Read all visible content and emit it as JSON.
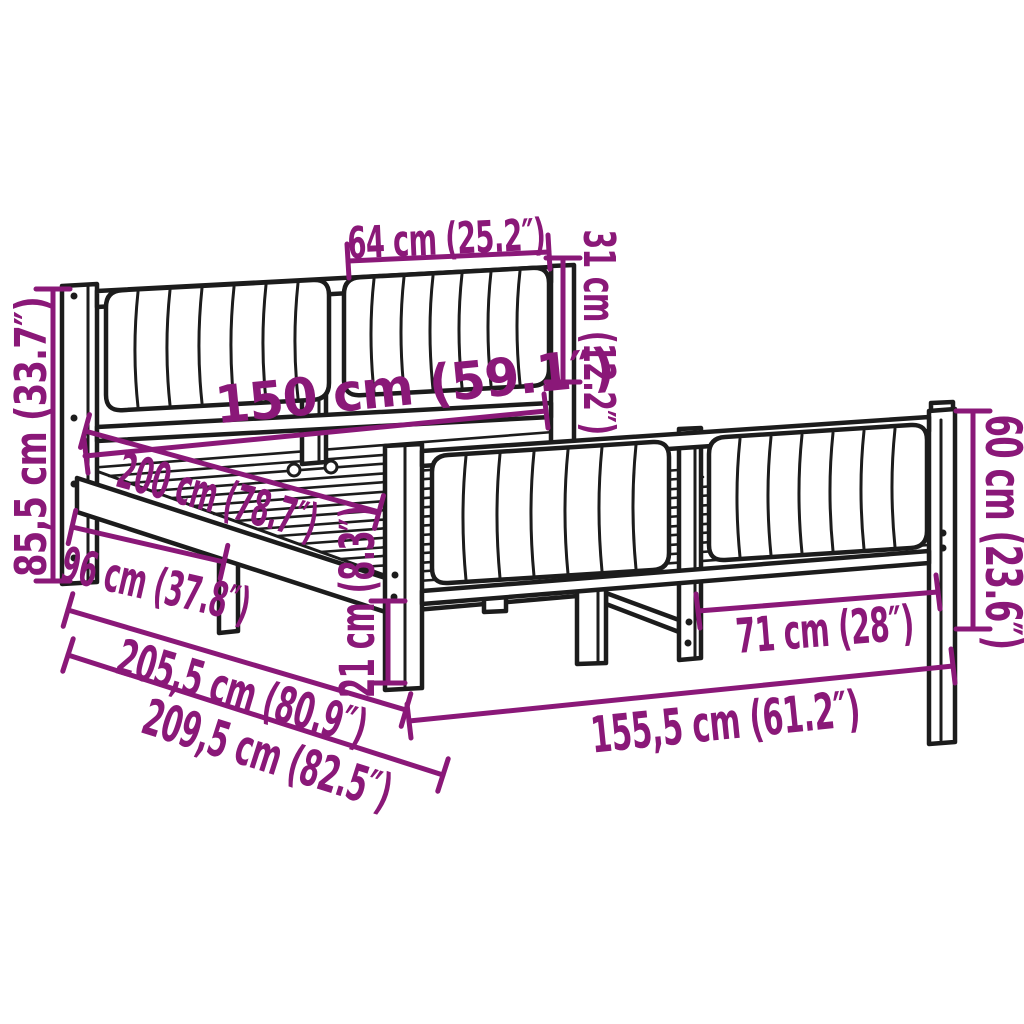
{
  "page": {
    "background_color": "#ffffff",
    "drawing_line_color": "#1c1c1c",
    "dimension_color": "#8a1878",
    "subject": "bed frame with upholstered headboard and footboard, perspective line drawing with dimension annotations"
  },
  "measurements": [
    {
      "id": "headboard-cushion-width",
      "label": "64 cm (25.2″)",
      "cm": "64",
      "inches": "25.2"
    },
    {
      "id": "headboard-cushion-height",
      "label": "31 cm (12.2″)",
      "cm": "31",
      "inches": "12.2"
    },
    {
      "id": "headboard-height",
      "label": "85,5 cm (33.7″)",
      "cm": "85,5",
      "inches": "33.7"
    },
    {
      "id": "mattress-width",
      "label": "150 cm (59.1″)",
      "cm": "150",
      "inches": "59.1"
    },
    {
      "id": "mattress-length",
      "label": "200 cm (78.7″)",
      "cm": "200",
      "inches": "78.7"
    },
    {
      "id": "side-support-distance",
      "label": "96 cm (37.8″)",
      "cm": "96",
      "inches": "37.8"
    },
    {
      "id": "under-bed-clearance",
      "label": "21 cm (8.3″)",
      "cm": "21",
      "inches": "8.3"
    },
    {
      "id": "frame-length",
      "label": "205,5 cm (80.9″)",
      "cm": "205,5",
      "inches": "80.9"
    },
    {
      "id": "total-length",
      "label": "209,5 cm (82.5″)",
      "cm": "209,5",
      "inches": "82.5"
    },
    {
      "id": "total-width",
      "label": "155,5 cm (61.2″)",
      "cm": "155,5",
      "inches": "61.2"
    },
    {
      "id": "footboard-section-width",
      "label": "71 cm (28″)",
      "cm": "71",
      "inches": "28"
    },
    {
      "id": "footboard-height",
      "label": "60 cm (23.6″)",
      "cm": "60",
      "inches": "23.6"
    }
  ]
}
